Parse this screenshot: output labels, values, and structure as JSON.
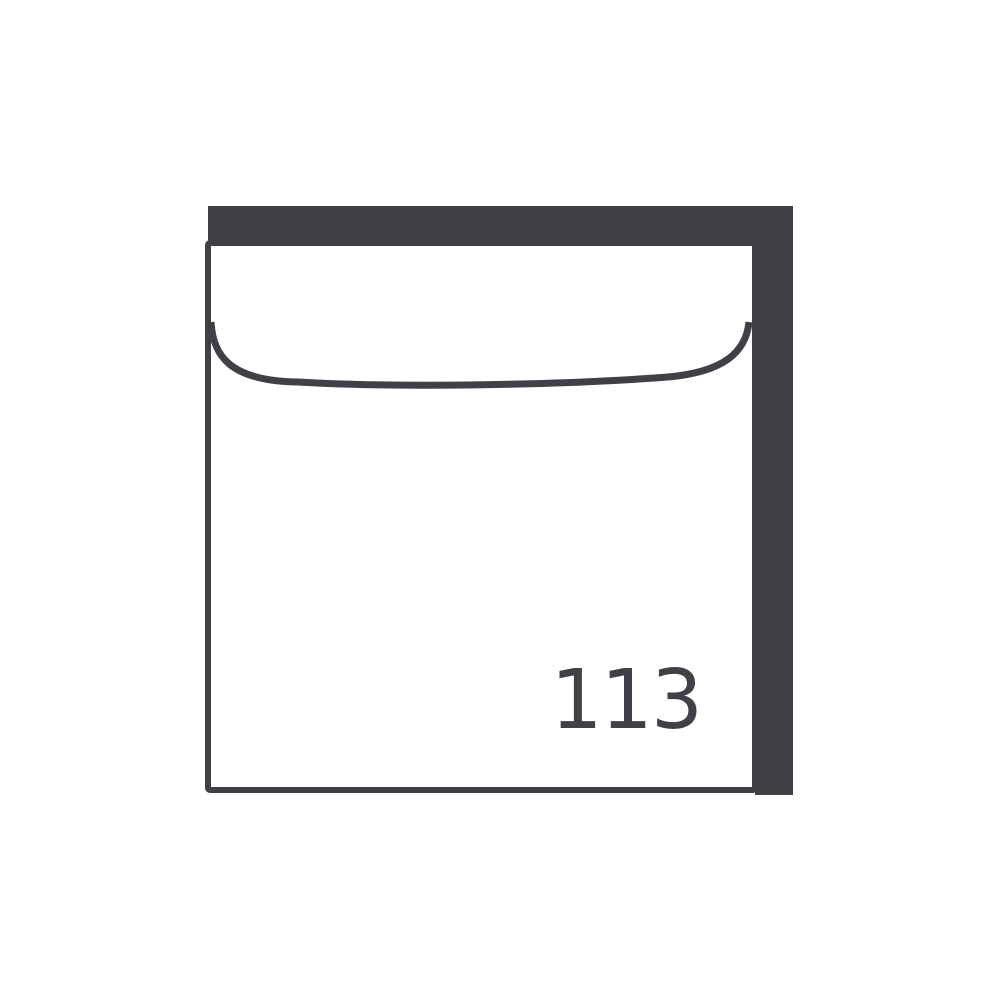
{
  "canvas": {
    "width": 1000,
    "height": 1000,
    "background": "#ffffff"
  },
  "colors": {
    "dark": "#414046",
    "white": "#ffffff"
  },
  "envelope": {
    "number": "113"
  }
}
